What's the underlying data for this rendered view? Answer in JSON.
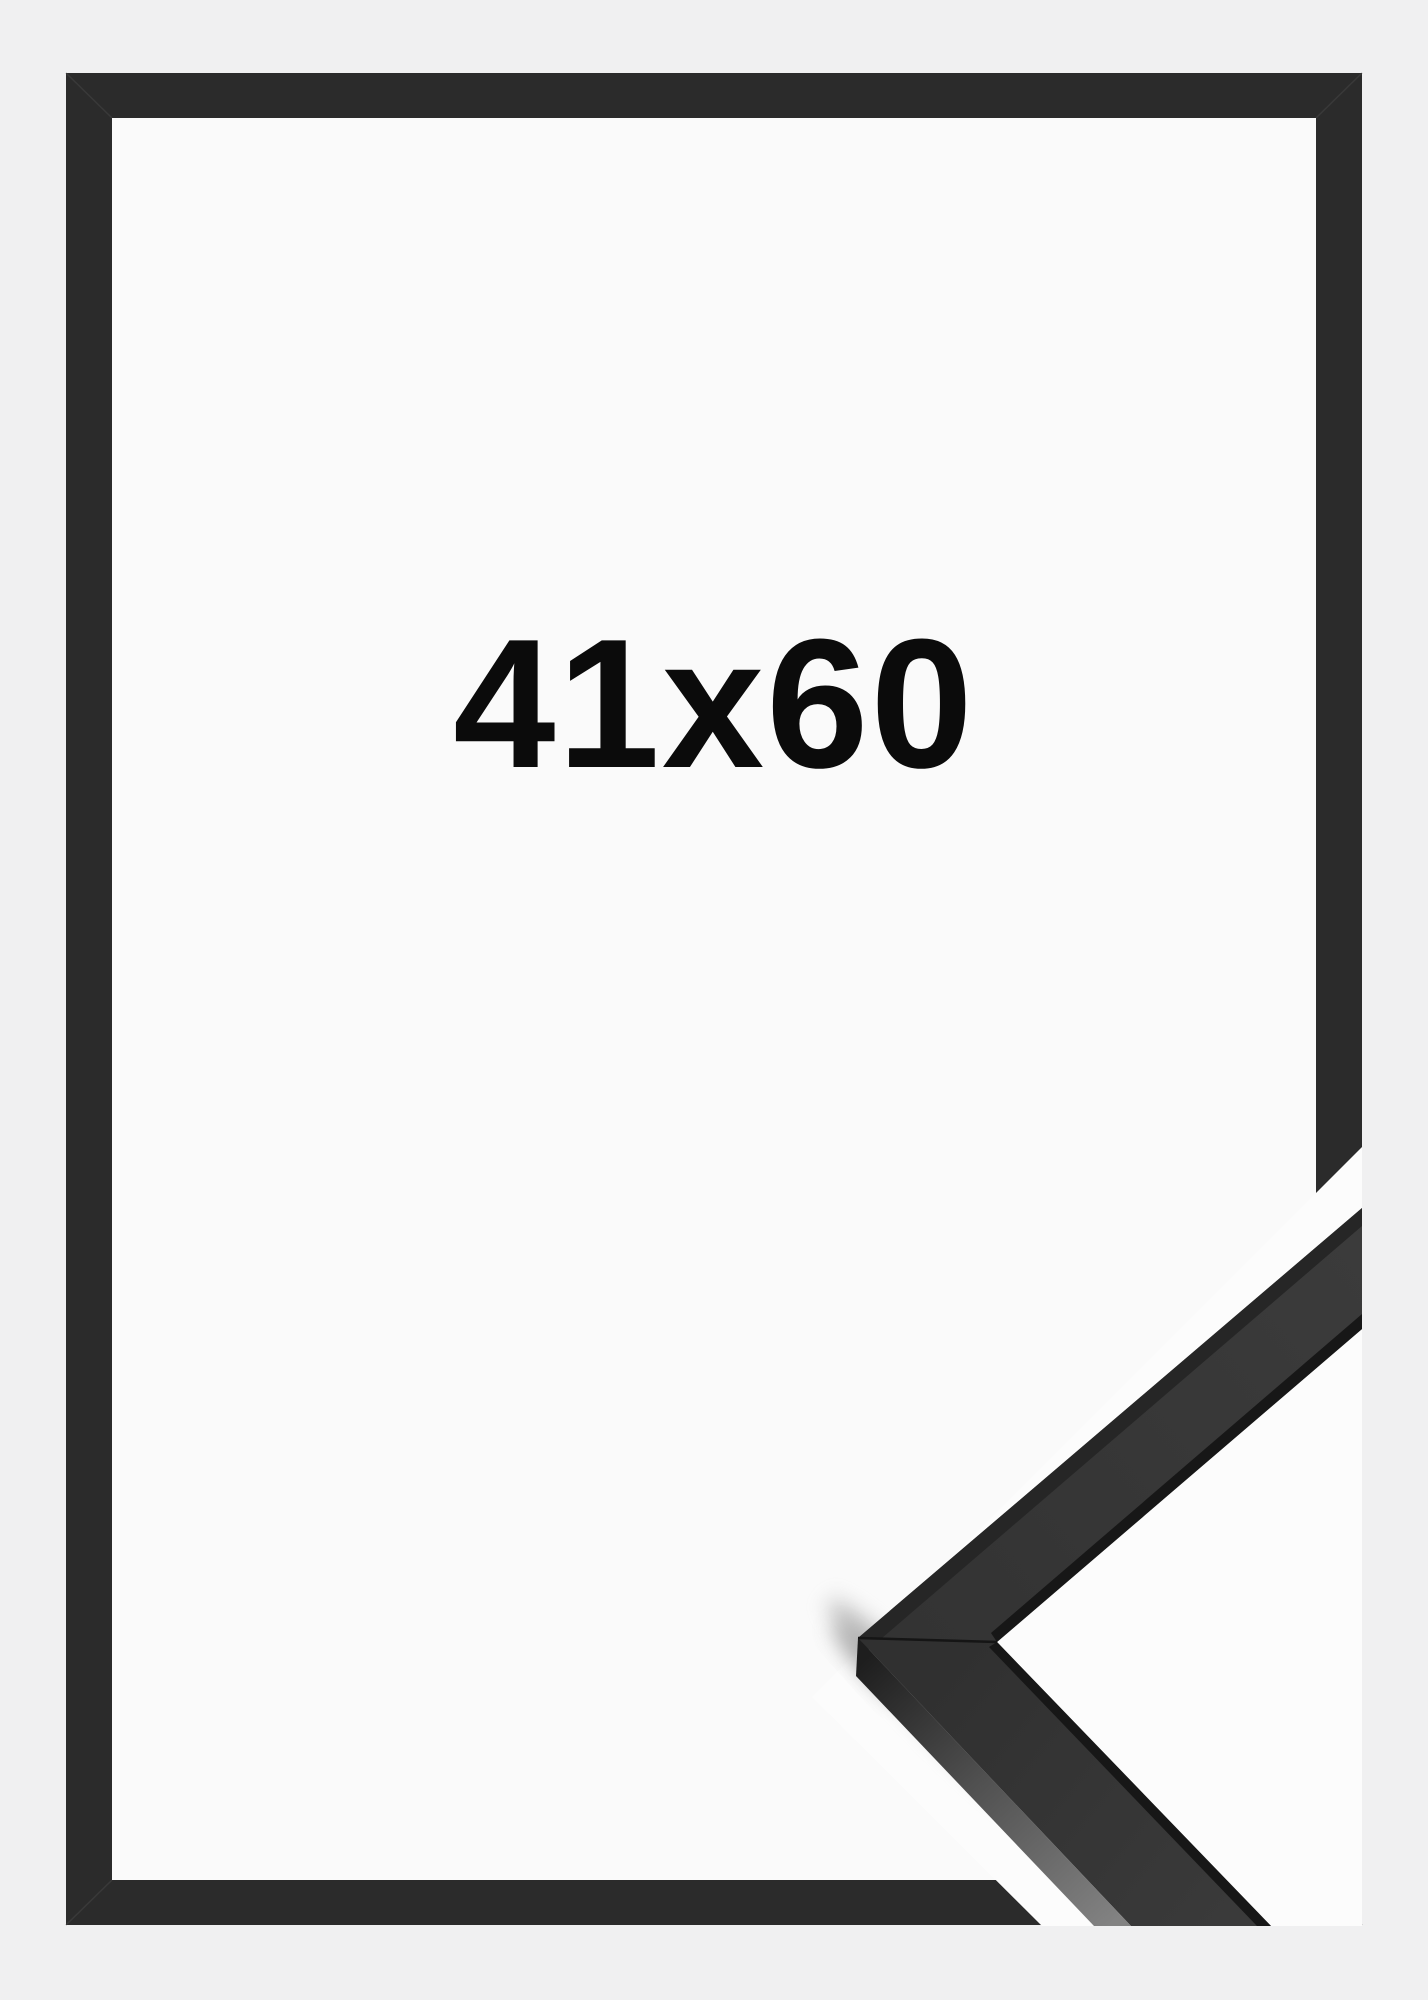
{
  "product_image": {
    "size_label": "41x60",
    "description": "Black picture frame product mockup with corner close-up detail"
  },
  "colors": {
    "background": "#f0f0f1",
    "frame": "#2b2b2b",
    "frame_opening": "#fafafa",
    "closeup_background": "#fcfcfc",
    "closeup_surface": "#383838",
    "closeup_surface_dark_edge": "#262626",
    "closeup_inner_lip": "#171717",
    "label": "#0b0b0b"
  }
}
